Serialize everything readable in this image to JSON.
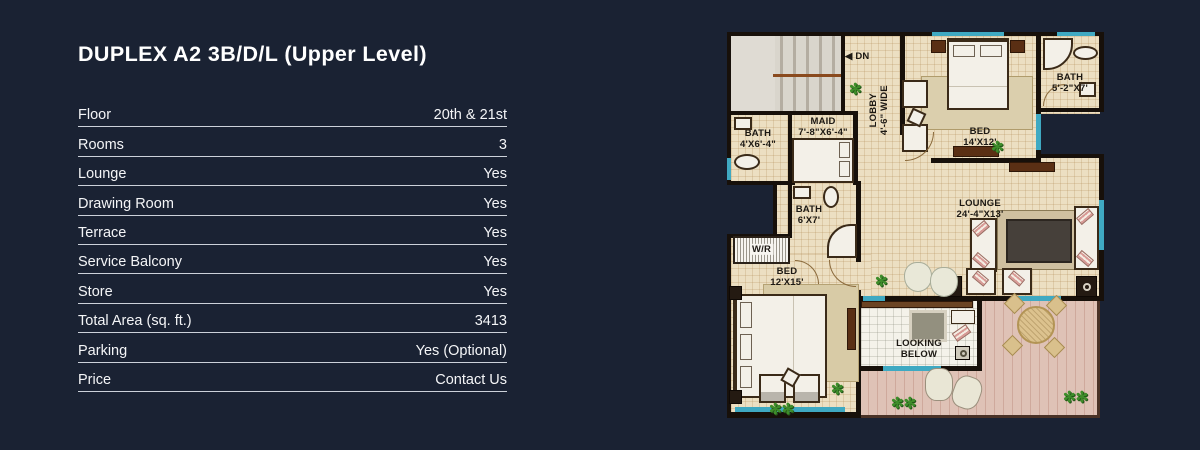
{
  "colors": {
    "background": "#1a2233",
    "accent_teal": "#3fa9c2",
    "plan_floor": "#ecdfc2",
    "deck": "#dfc2b6",
    "text": "#f4f5f7"
  },
  "header": {
    "title": "DUPLEX A2 3B/D/L (Upper Level)"
  },
  "specs": [
    {
      "label": "Floor",
      "value": "20th & 21st"
    },
    {
      "label": "Rooms",
      "value": "3"
    },
    {
      "label": "Lounge",
      "value": "Yes"
    },
    {
      "label": "Drawing Room",
      "value": "Yes"
    },
    {
      "label": "Terrace",
      "value": "Yes"
    },
    {
      "label": "Service Balcony",
      "value": "Yes"
    },
    {
      "label": "Store",
      "value": "Yes"
    },
    {
      "label": "Total Area (sq. ft.)",
      "value": "3413"
    },
    {
      "label": "Parking",
      "value": "Yes (Optional)"
    },
    {
      "label": "Price",
      "value": "Contact Us"
    }
  ],
  "floorplan": {
    "dn": "DN",
    "lobby": {
      "name": "LOBBY",
      "dims": "4'-6\" WIDE"
    },
    "maid": {
      "name": "MAID",
      "dims": "7'-8\"X6'-4\""
    },
    "bath_maid": {
      "name": "BATH",
      "dims": "4'X6'-4\""
    },
    "bed_master": {
      "name": "BED",
      "dims": "14'X12'"
    },
    "bath_master": {
      "name": "BATH",
      "dims": "5'-2\"X7'"
    },
    "bath_mid": {
      "name": "BATH",
      "dims": "6'X7'"
    },
    "wr": {
      "name": "W/R"
    },
    "bed_second": {
      "name": "BED",
      "dims": "12'X15'"
    },
    "lounge": {
      "name": "LOUNGE",
      "dims": "24'-4\"X13'"
    },
    "looking_below": {
      "line1": "LOOKING",
      "line2": "BELOW"
    }
  }
}
